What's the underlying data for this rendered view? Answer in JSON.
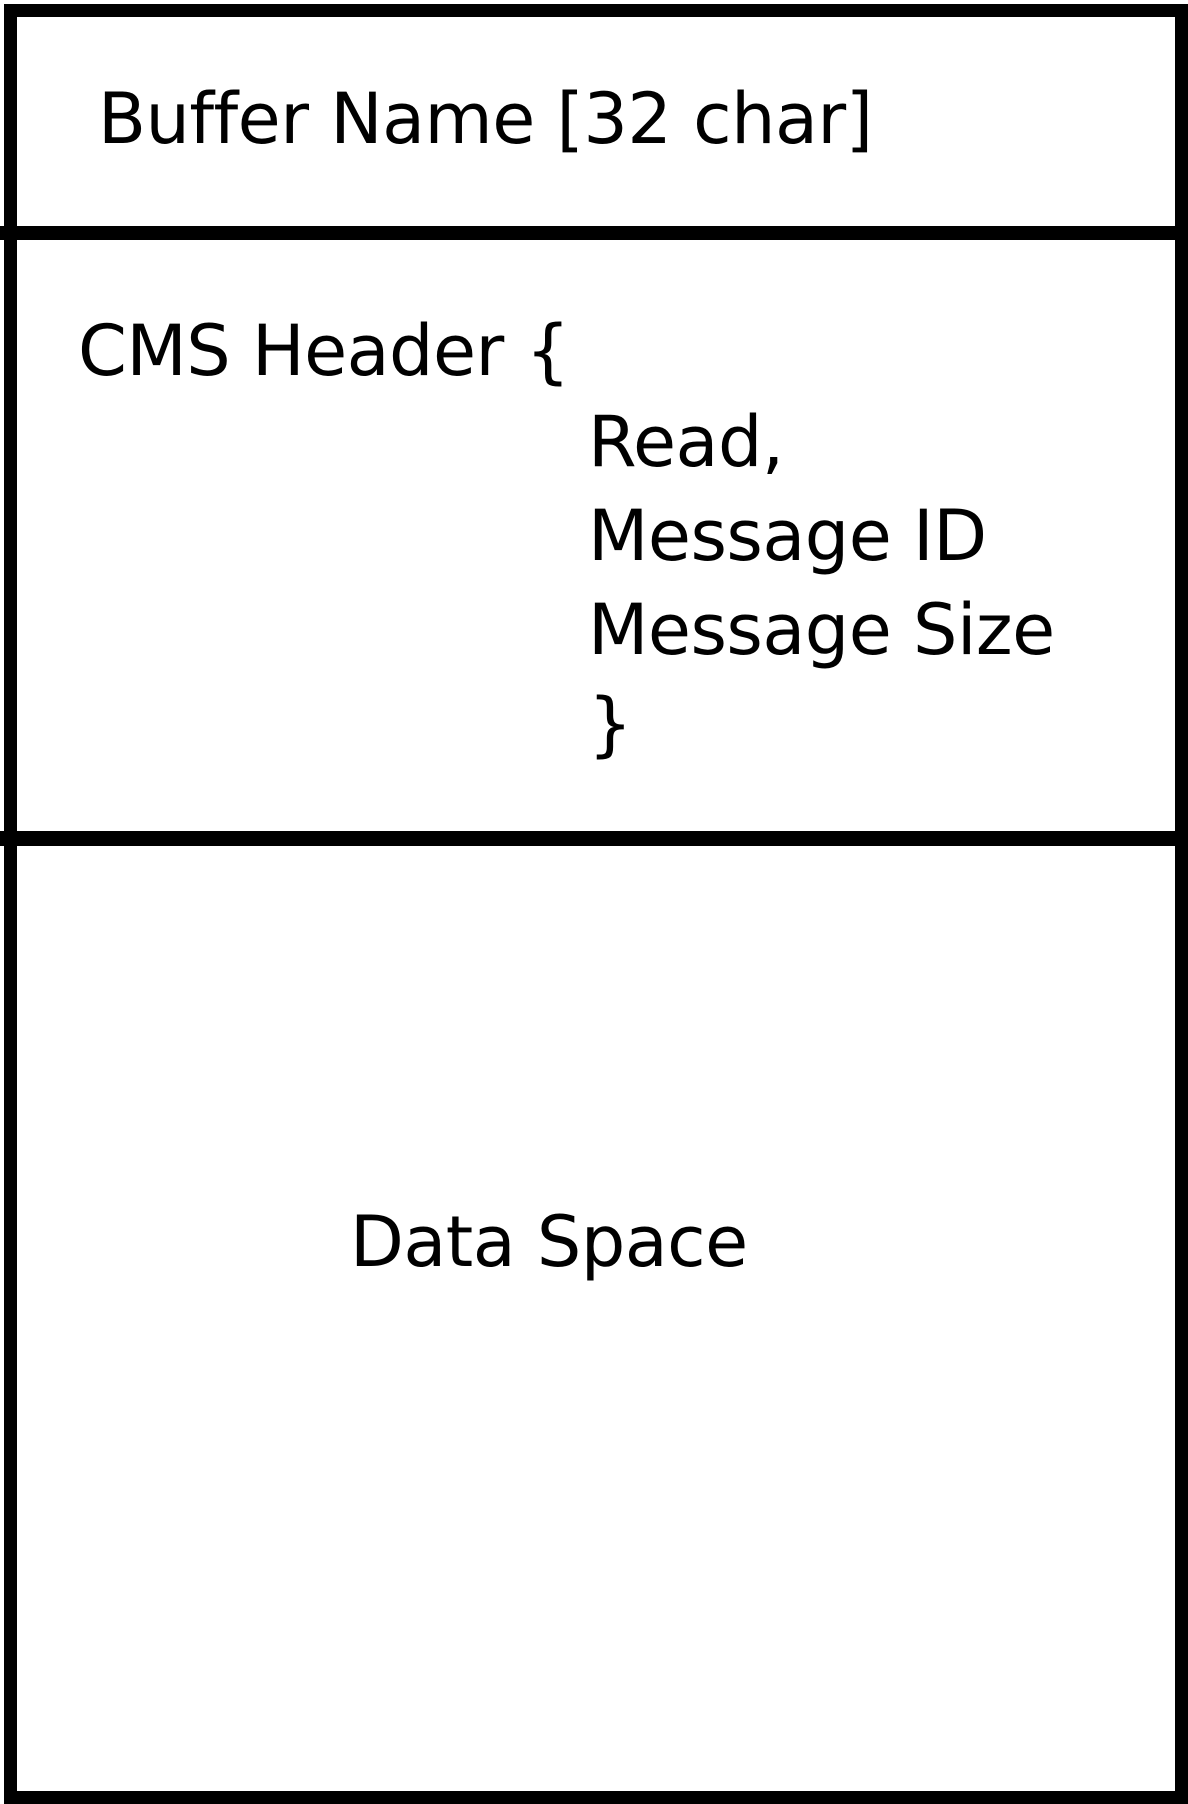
{
  "diagram": {
    "title": "shared memory buffer layout",
    "colors": {
      "background": "#ffffff",
      "border": "#000000",
      "text": "#000000"
    },
    "sections": [
      {
        "id": "buffer_name",
        "label": "Buffer Name [32 char]"
      },
      {
        "id": "cms_header",
        "header": "CMS Header {",
        "fields": [
          "Read,",
          "Message ID",
          "Message Size"
        ],
        "closing_brace": "}"
      },
      {
        "id": "data_space",
        "label": "Data Space"
      }
    ]
  }
}
